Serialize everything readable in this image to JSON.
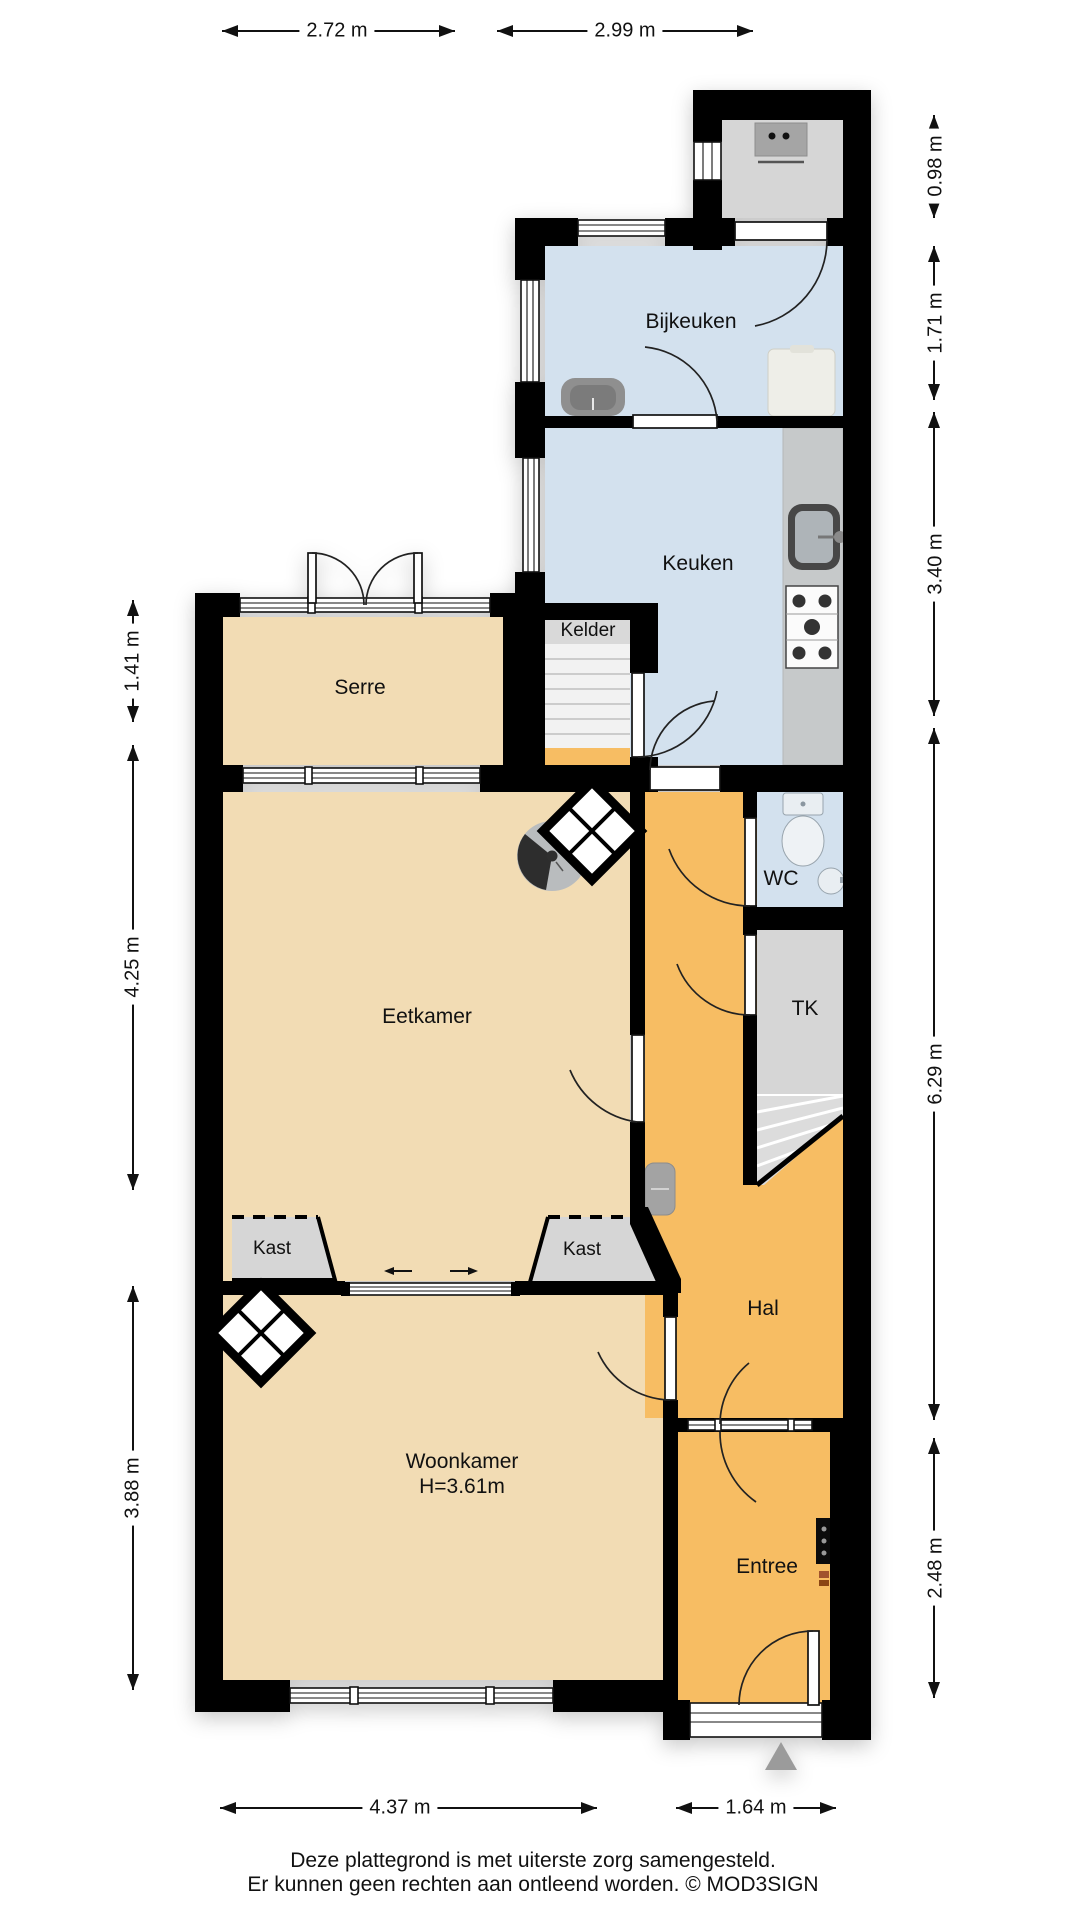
{
  "plan": {
    "rooms": {
      "bijkeuken": "Bijkeuken",
      "keuken": "Keuken",
      "kelder": "Kelder",
      "serre": "Serre",
      "eetkamer": "Eetkamer",
      "wc": "WC",
      "tk": "TK",
      "kast_left": "Kast",
      "kast_right": "Kast",
      "hal": "Hal",
      "woonkamer": "Woonkamer",
      "woonkamer_ceiling_height": "H=3.61m",
      "entree": "Entree"
    },
    "dimensions": {
      "top": [
        "2.72 m",
        "2.99 m"
      ],
      "right": [
        "0.98 m",
        "1.71 m",
        "3.40 m",
        "6.29 m",
        "2.48 m"
      ],
      "left": [
        "1.41 m",
        "4.25 m",
        "3.88 m"
      ],
      "bottom": [
        "4.37 m",
        "1.64 m"
      ]
    },
    "footer": {
      "line1": "Deze plattegrond is met uiterste zorg samengesteld.",
      "line2": "Er kunnen geen rechten aan ontleend worden. © MOD3SIGN"
    },
    "colors": {
      "wall": "#000000",
      "wet_rooms": "#d3e1ee",
      "living_rooms": "#f2dcb4",
      "hall": "#f7bd63",
      "closets": "#d6d6d6"
    }
  }
}
